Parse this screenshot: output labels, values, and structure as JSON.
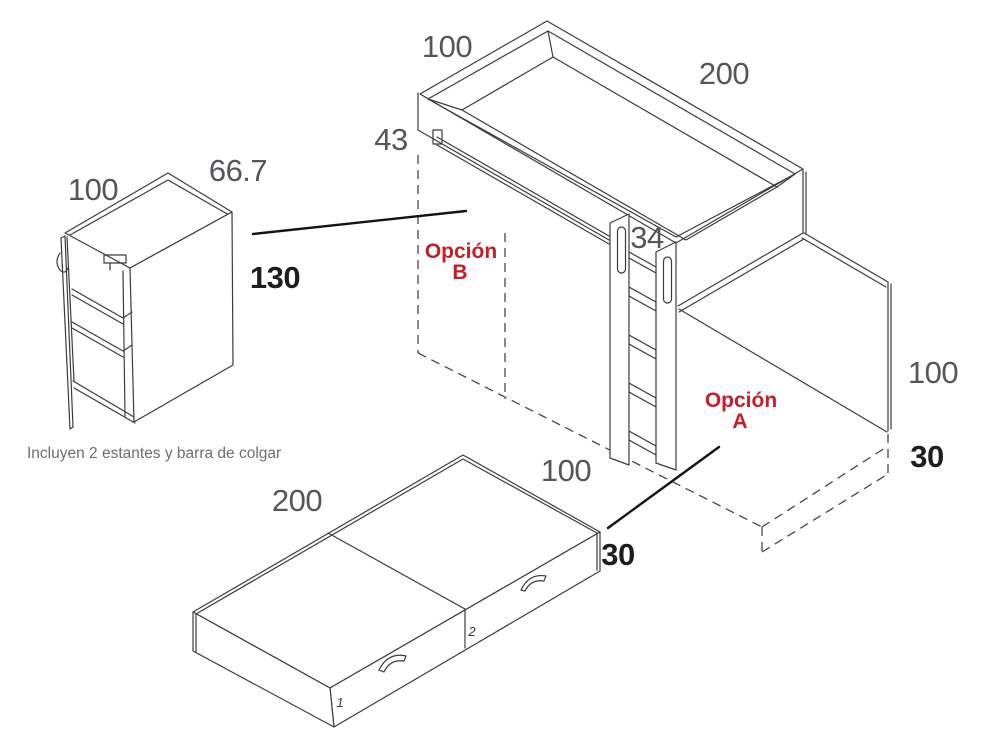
{
  "colors": {
    "red": "#c41e28",
    "dim_gray": "#54565b",
    "bold_black": "#1f1d1e",
    "line": "#3c3c3e",
    "caption_gray": "#6c6e70"
  },
  "wardrobe": {
    "width_label": "100",
    "depth_label": "66.7",
    "height_label": "130",
    "note": "Incluyen 2 estantes y barra de colgar"
  },
  "bed": {
    "width_label": "100",
    "length_label": "200",
    "rail_height_label": "43",
    "ladder_width_label": "34",
    "side_height_label": "100",
    "platform_height_label": "30",
    "underbed_depth_label": "100",
    "option_b_word": "Opción",
    "option_b_letter": "B",
    "option_a_word": "Opción",
    "option_a_letter": "A"
  },
  "bench": {
    "length_label": "200",
    "height_label": "30",
    "module1_label": "1",
    "module2_label": "2"
  }
}
